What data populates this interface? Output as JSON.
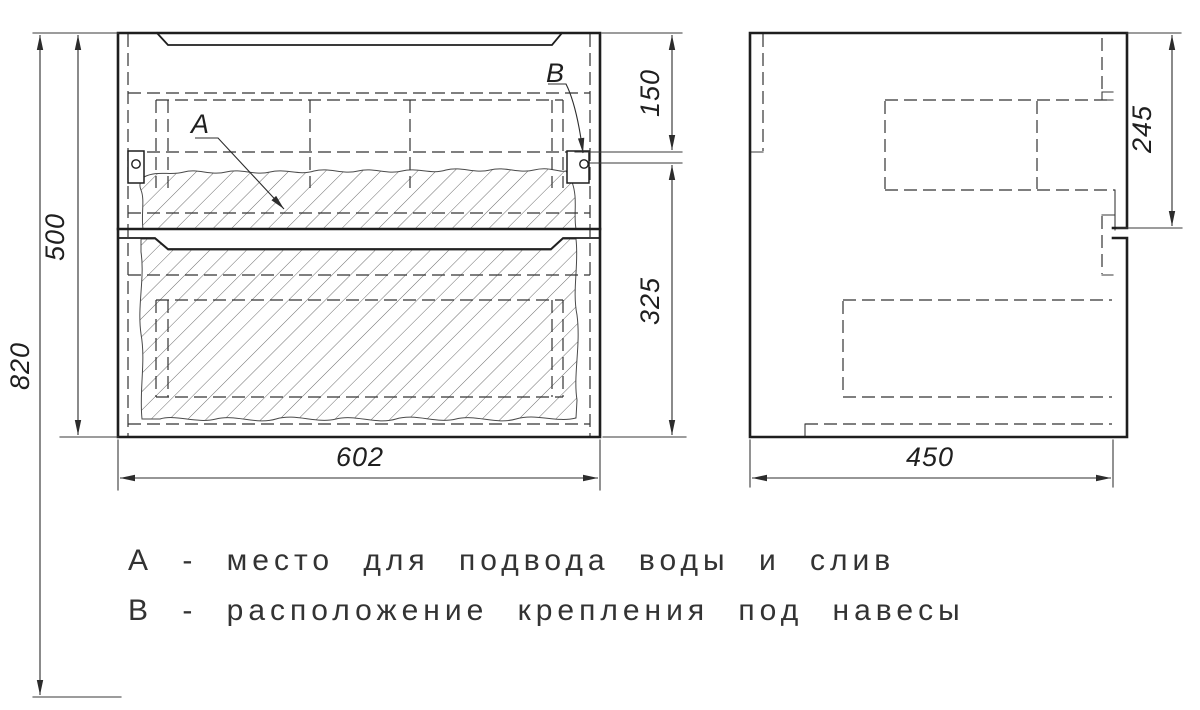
{
  "drawing_type": "cabinet-technical-drawing",
  "colors": {
    "background": "#ffffff",
    "line": "#1e1e1e",
    "hatch": "#6d6d6d"
  },
  "callouts": {
    "a": "А",
    "b": "В"
  },
  "dimensions": {
    "overall_height": "820",
    "carcass_height": "500",
    "width": "602",
    "top_to_hanger": "150",
    "hanger_to_bottom": "325",
    "depth": "450",
    "top_section_height": "245"
  },
  "notes": {
    "a": "А - место для подвода воды и слив",
    "b": "В - расположение крепления под навесы"
  }
}
